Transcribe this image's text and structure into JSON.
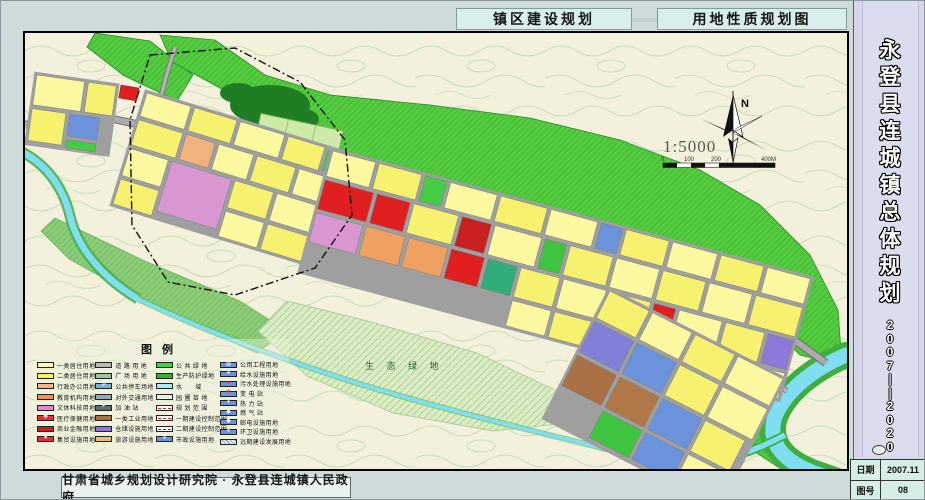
{
  "header": {
    "left_title": "镇区建设规划",
    "right_title": "用地性质规划图"
  },
  "sidebar": {
    "title": "永登县连城镇总体规划",
    "years": "2007——2020",
    "info": [
      {
        "label": "日期",
        "value": "2007.11"
      },
      {
        "label": "图号",
        "value": "08"
      }
    ]
  },
  "footer": {
    "credit": "甘肃省城乡规划设计研究院 · 永登县连城镇人民政府"
  },
  "map": {
    "north_label": "N",
    "scale_text": "1:5000",
    "scale_labels": [
      "0",
      "100",
      "200",
      "400M"
    ],
    "eco_label": "生 态 绿 地"
  },
  "legend": {
    "title": "图例",
    "columns": [
      {
        "items": [
          {
            "label": "一类居住用地",
            "color": "#fdfbb0"
          },
          {
            "label": "二类居住用地",
            "color": "#f9f266"
          },
          {
            "label": "行政办公用地",
            "color": "#f6b288"
          },
          {
            "label": "教育机构用地",
            "color": "#ef925e"
          },
          {
            "label": "文体科技用地",
            "color": "#e387d2"
          },
          {
            "label": "医疗保健用地",
            "color": "#e63232",
            "glyph": "✚",
            "glyph_color": "#ffffff"
          },
          {
            "label": "商业金融用地",
            "color": "#c32222"
          },
          {
            "label": "集贸设施用地",
            "color": "#e03030",
            "glyph": "✦",
            "glyph_color": "#ffffff"
          }
        ]
      },
      {
        "items": [
          {
            "label": "道 路 用 地",
            "color": "#b9b9b9"
          },
          {
            "label": "广 场 用 地",
            "color": "#a3c2a3"
          },
          {
            "label": "公共停车场地",
            "color": "#6fb6dc",
            "glyph": "P",
            "glyph_color": "#ffffff"
          },
          {
            "label": "对外交通用地",
            "color": "#94a5b6"
          },
          {
            "label": "加 油 站",
            "color": "#5d6c7c",
            "glyph": "P",
            "glyph_color": "#ffffff"
          },
          {
            "label": "一类工业用地",
            "color": "#a97046"
          },
          {
            "label": "仓储设施用地",
            "color": "#8d77d8"
          },
          {
            "label": "旅游设施用地",
            "color": "#e6bd7e"
          }
        ]
      },
      {
        "items": [
          {
            "label": "公 共 绿 地",
            "color": "#3ed43e"
          },
          {
            "label": "生产防护绿地",
            "color": "#2eb42e"
          },
          {
            "label": "水　　域",
            "color": "#a6e9f2"
          },
          {
            "label": "园 圃 苗 地",
            "color": "#e9f2dc"
          },
          {
            "label": "规 划 范 围",
            "line": {
              "color": "#e02020",
              "style": "dashed"
            }
          },
          {
            "label": "一期建设控制范围",
            "line": {
              "color": "#e02020",
              "style": "dashed"
            }
          },
          {
            "label": "二期建设控制范围",
            "line": {
              "color": "#2040d0",
              "style": "dashed"
            }
          },
          {
            "label": "市政设施用地",
            "color": "#6a93dc",
            "glyph": "●",
            "glyph_color": "#ffffff"
          }
        ]
      },
      {
        "items": [
          {
            "label": "公用工程用地",
            "color": "#6a93dc",
            "glyph": "◎",
            "glyph_color": "#ffffff"
          },
          {
            "label": "给水设施用地",
            "color": "#6a93dc",
            "glyph": "●",
            "glyph_color": "#ffffff"
          },
          {
            "label": "污水处理设施用地",
            "color": "#6a93dc",
            "glyph": "●",
            "glyph_color": "#e03030"
          },
          {
            "label": "变 电 站",
            "color": "#6a93dc",
            "glyph": "✦",
            "glyph_color": "#e03030"
          },
          {
            "label": "热 力 站",
            "color": "#6a93dc",
            "glyph": "●",
            "glyph_color": "#ffffff"
          },
          {
            "label": "燃 气 站",
            "color": "#6a93dc",
            "glyph": "◆",
            "glyph_color": "#ffffff"
          },
          {
            "label": "邮电设施用地",
            "color": "#6a93dc",
            "glyph": "◈",
            "glyph_color": "#ffffff"
          },
          {
            "label": "环卫设施用地",
            "color": "#6a93dc",
            "glyph": "●",
            "glyph_color": "#ffffff"
          },
          {
            "label": "远期建设发展用地",
            "hatch": true,
            "hatch_color": "#6a93dc"
          }
        ]
      }
    ]
  }
}
